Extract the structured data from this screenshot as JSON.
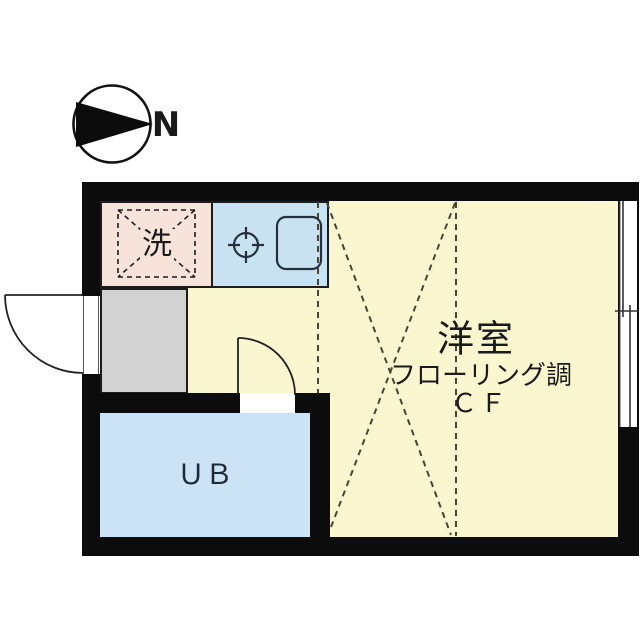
{
  "compass": {
    "north_label": "N"
  },
  "rooms": {
    "washer_space": {
      "label": "洗"
    },
    "main_room": {
      "name": "洋室",
      "flooring": "フローリング調",
      "floor_code": "ＣＦ"
    },
    "unit_bath": {
      "label": "ＵＢ"
    }
  },
  "colors": {
    "wall": "#0c0c0c",
    "main_room_fill": "#faf6d0",
    "kitchen_fill": "#c9e2f2",
    "bath_fill": "#cbe3f4",
    "washer_fill": "#f7e3da",
    "entrance_fill": "#d2d2d2",
    "dash_line": "#4a4433",
    "thin_line": "#1c1c1c"
  },
  "icons": {
    "north_compass": "circle-with-arrow",
    "gas_stove": "burner-circle-crosshair",
    "kitchen_sink": "rounded-rectangle",
    "washing_machine_space": "dashed-square-with-x",
    "entrance_door": "quarter-arc-swing",
    "bath_door": "quarter-arc-swing",
    "sliding_window": "double-line-in-wall"
  }
}
